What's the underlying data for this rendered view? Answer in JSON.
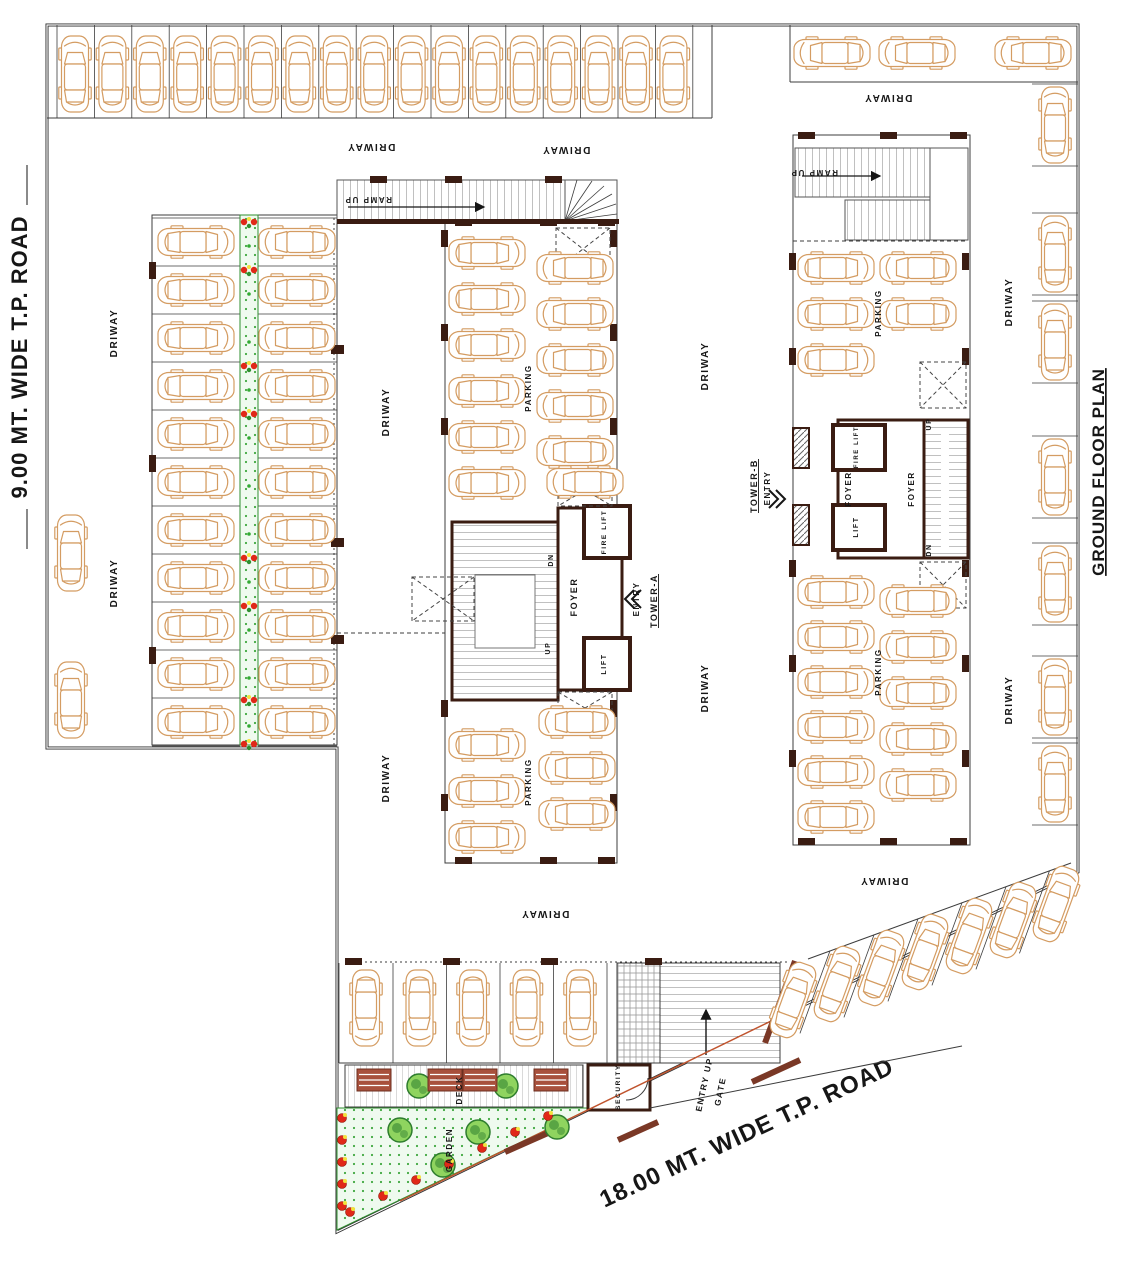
{
  "plan_title": "GROUND FLOOR PLAN",
  "roads": {
    "left": "9.00 MT. WIDE T.P. ROAD",
    "bottom": "18.00 MT. WIDE T.P. ROAD"
  },
  "colors": {
    "car": "#d49c62",
    "wall": "#3a1c12",
    "line": "#3c3c3c",
    "text": "#161616",
    "hatch": "#828282",
    "green_bg": "#effaef",
    "green_dot": "#3fa83f",
    "tree": "#2e7d2e",
    "tree_light": "#8fd45f",
    "flower_red": "#e02818",
    "flower_yellow": "#f2e23c",
    "bench": "#a8503c",
    "gate": "#7a3826",
    "boundary_red": "#c0542e"
  },
  "labels": [
    {
      "t": "DRIWAY",
      "x": 371,
      "y": 144,
      "r": 180,
      "s": 10
    },
    {
      "t": "DRIWAY",
      "x": 566,
      "y": 147,
      "r": 180,
      "s": 10
    },
    {
      "t": "DRIWAY",
      "x": 888,
      "y": 95,
      "r": 180,
      "s": 10
    },
    {
      "t": "DRIWAY",
      "x": 545,
      "y": 911,
      "r": 180,
      "s": 10
    },
    {
      "t": "DRIWAY",
      "x": 884,
      "y": 878,
      "r": 180,
      "s": 10
    },
    {
      "t": "DRIWAY",
      "x": 117,
      "y": 333,
      "r": -90,
      "s": 10
    },
    {
      "t": "DRIWAY",
      "x": 117,
      "y": 583,
      "r": -90,
      "s": 10
    },
    {
      "t": "DRIWAY",
      "x": 389,
      "y": 412,
      "r": -90,
      "s": 10
    },
    {
      "t": "DRIWAY",
      "x": 389,
      "y": 778,
      "r": -90,
      "s": 10
    },
    {
      "t": "DRIWAY",
      "x": 708,
      "y": 366,
      "r": -90,
      "s": 10
    },
    {
      "t": "DRIWAY",
      "x": 708,
      "y": 688,
      "r": -90,
      "s": 10
    },
    {
      "t": "DRIWAY",
      "x": 1012,
      "y": 302,
      "r": -90,
      "s": 10
    },
    {
      "t": "DRIWAY",
      "x": 1012,
      "y": 700,
      "r": -90,
      "s": 10
    },
    {
      "t": "PARKING",
      "x": 531,
      "y": 388,
      "r": -90,
      "s": 8
    },
    {
      "t": "PARKING",
      "x": 531,
      "y": 782,
      "r": -90,
      "s": 8
    },
    {
      "t": "PARKING",
      "x": 881,
      "y": 313,
      "r": -90,
      "s": 8
    },
    {
      "t": "PARKING",
      "x": 881,
      "y": 672,
      "r": -90,
      "s": 8
    },
    {
      "t": "RAMP UP",
      "x": 368,
      "y": 197,
      "r": 180,
      "s": 8
    },
    {
      "t": "RAMP UP",
      "x": 814,
      "y": 170,
      "r": 180,
      "s": 8
    },
    {
      "t": "FOYER",
      "x": 577,
      "y": 597,
      "r": -90,
      "s": 9
    },
    {
      "t": "FIRE LIFT",
      "x": 606,
      "y": 532,
      "r": -90,
      "s": 6.5
    },
    {
      "t": "LIFT",
      "x": 606,
      "y": 664,
      "r": -90,
      "s": 7
    },
    {
      "t": "DN",
      "x": 553,
      "y": 560,
      "r": -90,
      "s": 7
    },
    {
      "t": "UP",
      "x": 550,
      "y": 648,
      "r": -90,
      "s": 7
    },
    {
      "t": "ENTRY",
      "x": 639,
      "y": 599,
      "r": -90,
      "s": 8
    },
    {
      "t": "TOWER-A",
      "x": 657,
      "y": 601,
      "r": -90,
      "s": 9,
      "u": 1
    },
    {
      "t": "FOYER",
      "x": 851,
      "y": 489,
      "r": -90,
      "s": 8
    },
    {
      "t": "FOYER",
      "x": 914,
      "y": 489,
      "r": -90,
      "s": 8
    },
    {
      "t": "FIRE LIFT",
      "x": 858,
      "y": 447,
      "r": -90,
      "s": 6
    },
    {
      "t": "LIFT",
      "x": 858,
      "y": 527,
      "r": -90,
      "s": 7
    },
    {
      "t": "UP",
      "x": 931,
      "y": 424,
      "r": -90,
      "s": 7
    },
    {
      "t": "DN",
      "x": 931,
      "y": 550,
      "r": -90,
      "s": 7
    },
    {
      "t": "TOWER-B",
      "x": 757,
      "y": 486,
      "r": -90,
      "s": 9,
      "u": 1
    },
    {
      "t": "ENTRY",
      "x": 770,
      "y": 488,
      "r": -90,
      "s": 8
    },
    {
      "t": "SECURITY",
      "x": 620,
      "y": 1087,
      "r": -90,
      "s": 6.5
    },
    {
      "t": "DECK",
      "x": 462,
      "y": 1090,
      "r": -90,
      "s": 8
    },
    {
      "t": "GARDEN",
      "x": 452,
      "y": 1150,
      "r": -90,
      "s": 8
    },
    {
      "t": "ENTRY UP",
      "x": 707,
      "y": 1085,
      "r": -78,
      "s": 8.5
    },
    {
      "t": "GATE",
      "x": 723,
      "y": 1092,
      "r": -78,
      "s": 8.5
    }
  ],
  "cars": [
    {
      "x": 75,
      "y": 74,
      "r": 0,
      "n": 17,
      "dx": 37.4,
      "dy": 0
    },
    {
      "x": 832,
      "y": 53,
      "r": -90,
      "n": 2,
      "dx": 85,
      "dy": 0
    },
    {
      "x": 1033,
      "y": 53,
      "r": -90,
      "n": 1
    },
    {
      "x": 1055,
      "r": 0,
      "ys": [
        125,
        254,
        342,
        477,
        584,
        697,
        784
      ]
    },
    {
      "x": 196,
      "y": 242,
      "r": 90,
      "n": 11,
      "dy": 48
    },
    {
      "x": 297,
      "y": 242,
      "r": -90,
      "n": 11,
      "dy": 48
    },
    {
      "x": 71,
      "y": 553,
      "r": 0,
      "n": 1
    },
    {
      "x": 71,
      "y": 700,
      "r": 0,
      "n": 1
    },
    {
      "x": 487,
      "y": 253,
      "r": 90,
      "n": 6,
      "dy": 46
    },
    {
      "x": 487,
      "y": 745,
      "r": 90,
      "n": 3,
      "dy": 46
    },
    {
      "x": 575,
      "y": 268,
      "r": -90,
      "n": 5,
      "dy": 46
    },
    {
      "x": 585,
      "y": 482,
      "r": -90,
      "n": 1
    },
    {
      "x": 577,
      "y": 722,
      "r": -90,
      "n": 3,
      "dy": 46
    },
    {
      "x": 836,
      "y": 268,
      "r": 90,
      "n": 3,
      "dy": 46
    },
    {
      "x": 918,
      "y": 268,
      "r": -90,
      "n": 2,
      "dy": 46
    },
    {
      "x": 836,
      "y": 592,
      "r": 90,
      "n": 6,
      "dy": 45
    },
    {
      "x": 918,
      "y": 601,
      "r": -90,
      "n": 5,
      "dy": 46
    },
    {
      "x": 366,
      "y": 1008,
      "r": 180,
      "n": 5,
      "dx": 53.5
    },
    {
      "r": 20,
      "pts": [
        [
          793,
          1000
        ],
        [
          837,
          984
        ],
        [
          881,
          968
        ],
        [
          925,
          952
        ],
        [
          969,
          936
        ],
        [
          1013,
          920
        ],
        [
          1056,
          904
        ]
      ]
    }
  ],
  "trees": [
    [
      419,
      1086
    ],
    [
      506,
      1086
    ],
    [
      400,
      1130
    ],
    [
      478,
      1132
    ],
    [
      557,
      1127
    ],
    [
      443,
      1165
    ]
  ],
  "median_flowers": {
    "x": 249,
    "cluster_ys": [
      222,
      270,
      366,
      414,
      558,
      606,
      700,
      744
    ],
    "sprout_ys": [
      246,
      294,
      342,
      390,
      438,
      486,
      534,
      582,
      630,
      678,
      726
    ]
  },
  "garden_bushes": [
    [
      342,
      1118
    ],
    [
      342,
      1140
    ],
    [
      342,
      1162
    ],
    [
      342,
      1184
    ],
    [
      342,
      1206
    ],
    [
      350,
      1212
    ],
    [
      383,
      1196
    ],
    [
      416,
      1180
    ],
    [
      449,
      1164
    ],
    [
      482,
      1148
    ],
    [
      515,
      1132
    ],
    [
      548,
      1116
    ]
  ],
  "benches": [
    [
      357,
      1069
    ],
    [
      428,
      1069
    ],
    [
      463,
      1069
    ],
    [
      534,
      1069
    ]
  ]
}
